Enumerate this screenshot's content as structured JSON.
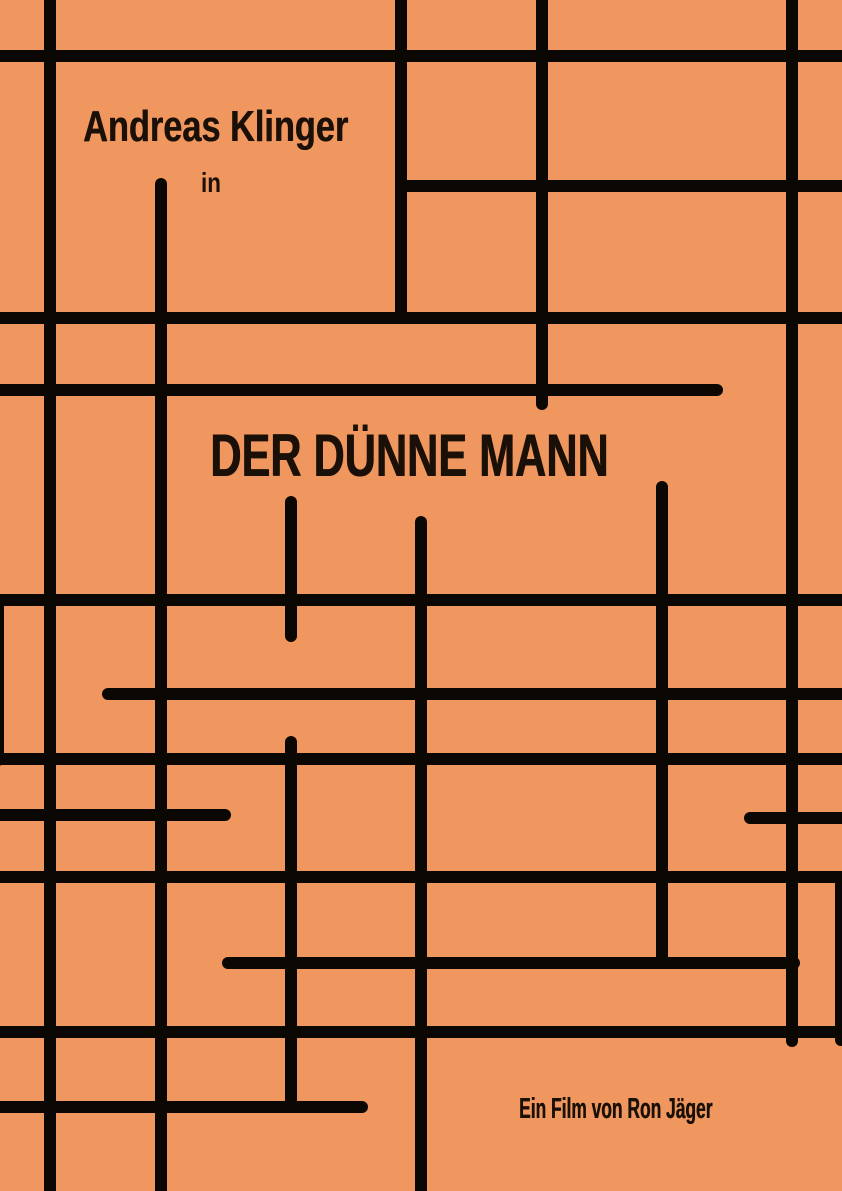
{
  "poster": {
    "background_color": "#EF975E",
    "line_color": "#0B0703",
    "text_color": "#1A1008",
    "actor_name": "Andreas Klinger",
    "connector": "in",
    "title": "DER DÜNNE MANN",
    "credit": "Ein Film von Ron Jäger"
  },
  "grid_lines": {
    "thickness": 12,
    "horizontal": [
      {
        "x": -10,
        "y": 50,
        "len": 862
      },
      {
        "x": 399,
        "y": 180,
        "len": 453
      },
      {
        "x": -10,
        "y": 312,
        "len": 862
      },
      {
        "x": -10,
        "y": 384,
        "len": 733
      },
      {
        "x": -10,
        "y": 594,
        "len": 862
      },
      {
        "x": 102,
        "y": 688,
        "len": 750
      },
      {
        "x": -10,
        "y": 753,
        "len": 862
      },
      {
        "x": -10,
        "y": 809,
        "len": 241
      },
      {
        "x": 744,
        "y": 812,
        "len": 108
      },
      {
        "x": -10,
        "y": 871,
        "len": 862
      },
      {
        "x": 222,
        "y": 957,
        "len": 578
      },
      {
        "x": -10,
        "y": 1026,
        "len": 862
      },
      {
        "x": -10,
        "y": 1101,
        "len": 378
      }
    ],
    "vertical": [
      {
        "x": -8,
        "y": 598,
        "len": 168
      },
      {
        "x": 44,
        "y": -10,
        "len": 1211
      },
      {
        "x": 155,
        "y": 178,
        "len": 1023
      },
      {
        "x": 285,
        "y": 496,
        "len": 146
      },
      {
        "x": 285,
        "y": 736,
        "len": 377
      },
      {
        "x": 395,
        "y": -10,
        "len": 328
      },
      {
        "x": 415,
        "y": 516,
        "len": 685
      },
      {
        "x": 536,
        "y": -10,
        "len": 420
      },
      {
        "x": 656,
        "y": 481,
        "len": 488
      },
      {
        "x": 786,
        "y": -10,
        "len": 1057
      },
      {
        "x": 835,
        "y": 871,
        "len": 175
      }
    ]
  }
}
